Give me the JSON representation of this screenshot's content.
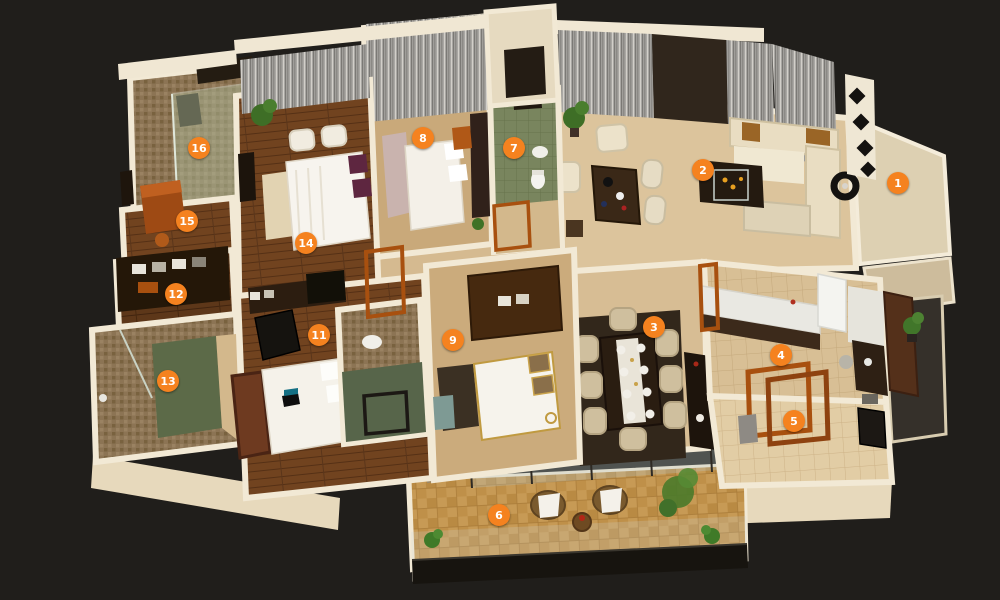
{
  "scene": {
    "type": "3d-apartment-floor-plan",
    "background_color": "#201e1b",
    "wall_color": "#f2e9d5",
    "marker_color": "#f5821f",
    "marker_text_color": "#ffffff"
  },
  "markers": [
    {
      "label": "1",
      "name": "entrance",
      "x": 898,
      "y": 183
    },
    {
      "label": "2",
      "name": "living-room",
      "x": 703,
      "y": 170
    },
    {
      "label": "3",
      "name": "dining-area",
      "x": 654,
      "y": 327
    },
    {
      "label": "4",
      "name": "kitchen",
      "x": 781,
      "y": 355
    },
    {
      "label": "5",
      "name": "utility-passage",
      "x": 794,
      "y": 421
    },
    {
      "label": "6",
      "name": "balcony",
      "x": 499,
      "y": 515
    },
    {
      "label": "7",
      "name": "bathroom-2",
      "x": 514,
      "y": 148
    },
    {
      "label": "8",
      "name": "bedroom-2",
      "x": 423,
      "y": 138
    },
    {
      "label": "9",
      "name": "bedroom-3",
      "x": 453,
      "y": 340
    },
    {
      "label": "11",
      "name": "bedroom-4",
      "x": 319,
      "y": 335
    },
    {
      "label": "12",
      "name": "walk-in-closet",
      "x": 176,
      "y": 294
    },
    {
      "label": "13",
      "name": "bathroom-3",
      "x": 168,
      "y": 381
    },
    {
      "label": "14",
      "name": "master-bedroom",
      "x": 306,
      "y": 243
    },
    {
      "label": "15",
      "name": "dressing-area",
      "x": 187,
      "y": 221
    },
    {
      "label": "16",
      "name": "master-bathroom",
      "x": 199,
      "y": 148
    }
  ]
}
